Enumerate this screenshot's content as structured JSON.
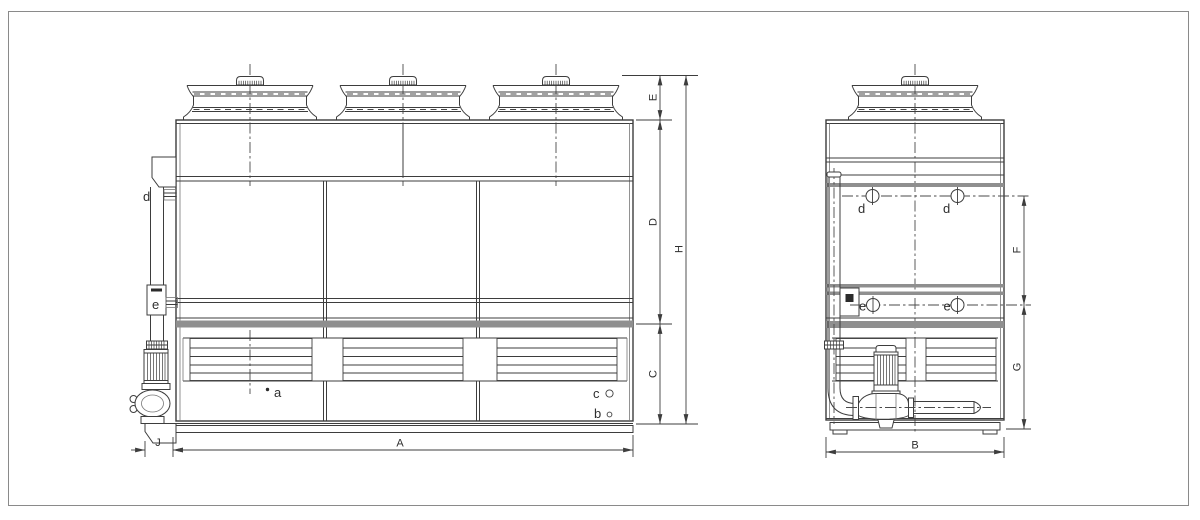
{
  "front_view": {
    "dims": {
      "A": "A",
      "J": "J",
      "C": "C",
      "D": "D",
      "E": "E",
      "H": "H"
    },
    "connections": {
      "a": "a",
      "b": "b",
      "c": "c",
      "d": "d",
      "e": "e"
    }
  },
  "side_view": {
    "dims": {
      "B": "B",
      "F": "F",
      "G": "G"
    },
    "connections": {
      "d1": "d",
      "d2": "d",
      "e1": "e",
      "e2": "e"
    }
  },
  "colors": {
    "line": "#3d3d3d",
    "band_gray": "#8f8f8f",
    "background": "#ffffff",
    "border": "#8a8a8a"
  }
}
